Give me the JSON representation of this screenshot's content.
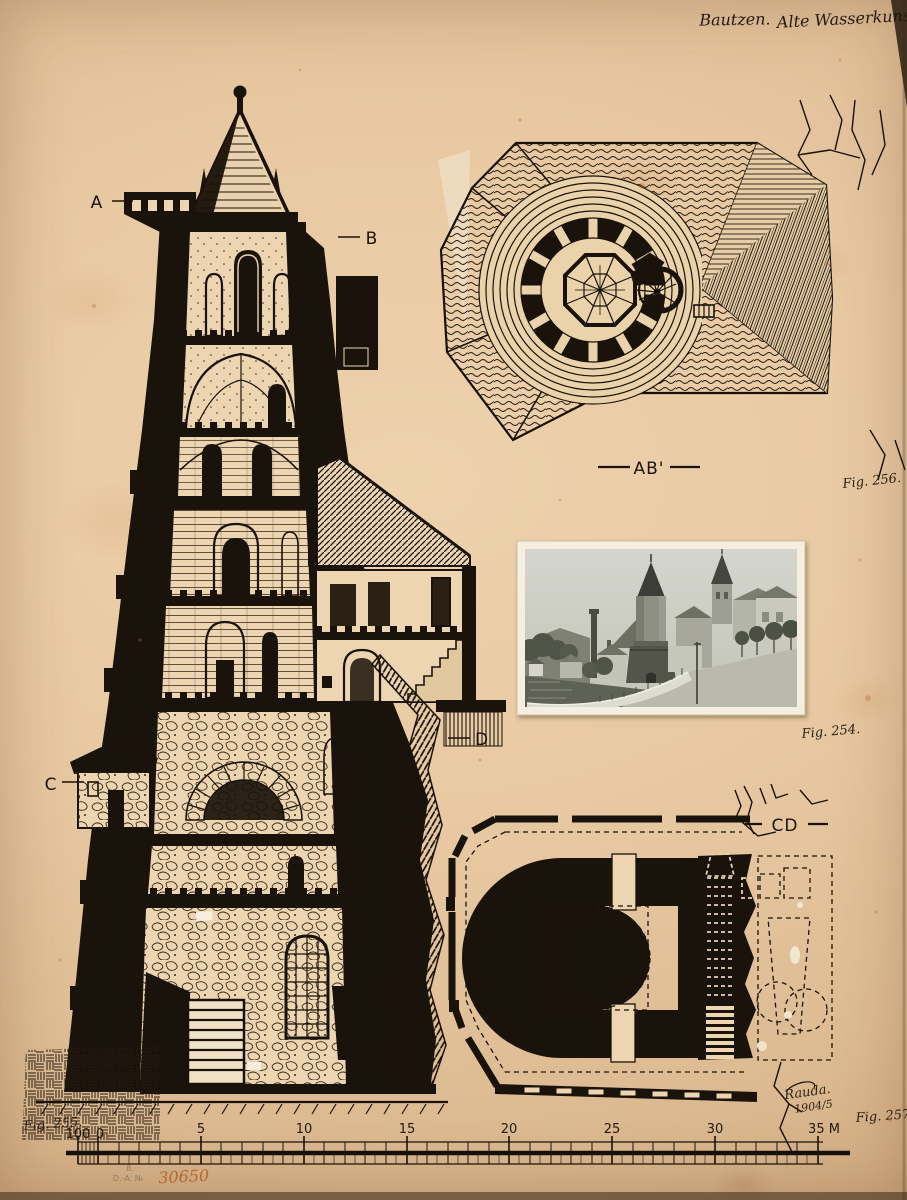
{
  "plate": {
    "handwritten_title_left": "Bautzen.",
    "handwritten_title_right": "Alte Wasserkunst.",
    "paper_color": "#e7c8a1",
    "ink_color": "#1a130b"
  },
  "section": {
    "label_a": "A",
    "label_b": "B",
    "label_c": "C",
    "label_d": "D",
    "fig_label": "Fig. 255."
  },
  "roof_plan": {
    "section_line_label": "AB'",
    "fig_label": "Fig. 256."
  },
  "photo": {
    "fig_label": "Fig. 254."
  },
  "floor_plan": {
    "section_line_label": "CD",
    "fig_label": "Fig. 257.",
    "signature": "Rauda.",
    "signature_year": "1904/5"
  },
  "scale_bar": {
    "labels": [
      "100",
      "0",
      "5",
      "10",
      "15",
      "20",
      "25",
      "30",
      "35 M"
    ]
  },
  "stamp": {
    "line_top": "8.",
    "line_bottom": "D.-A. №",
    "number": "30650",
    "number_color": "#b4672f"
  }
}
